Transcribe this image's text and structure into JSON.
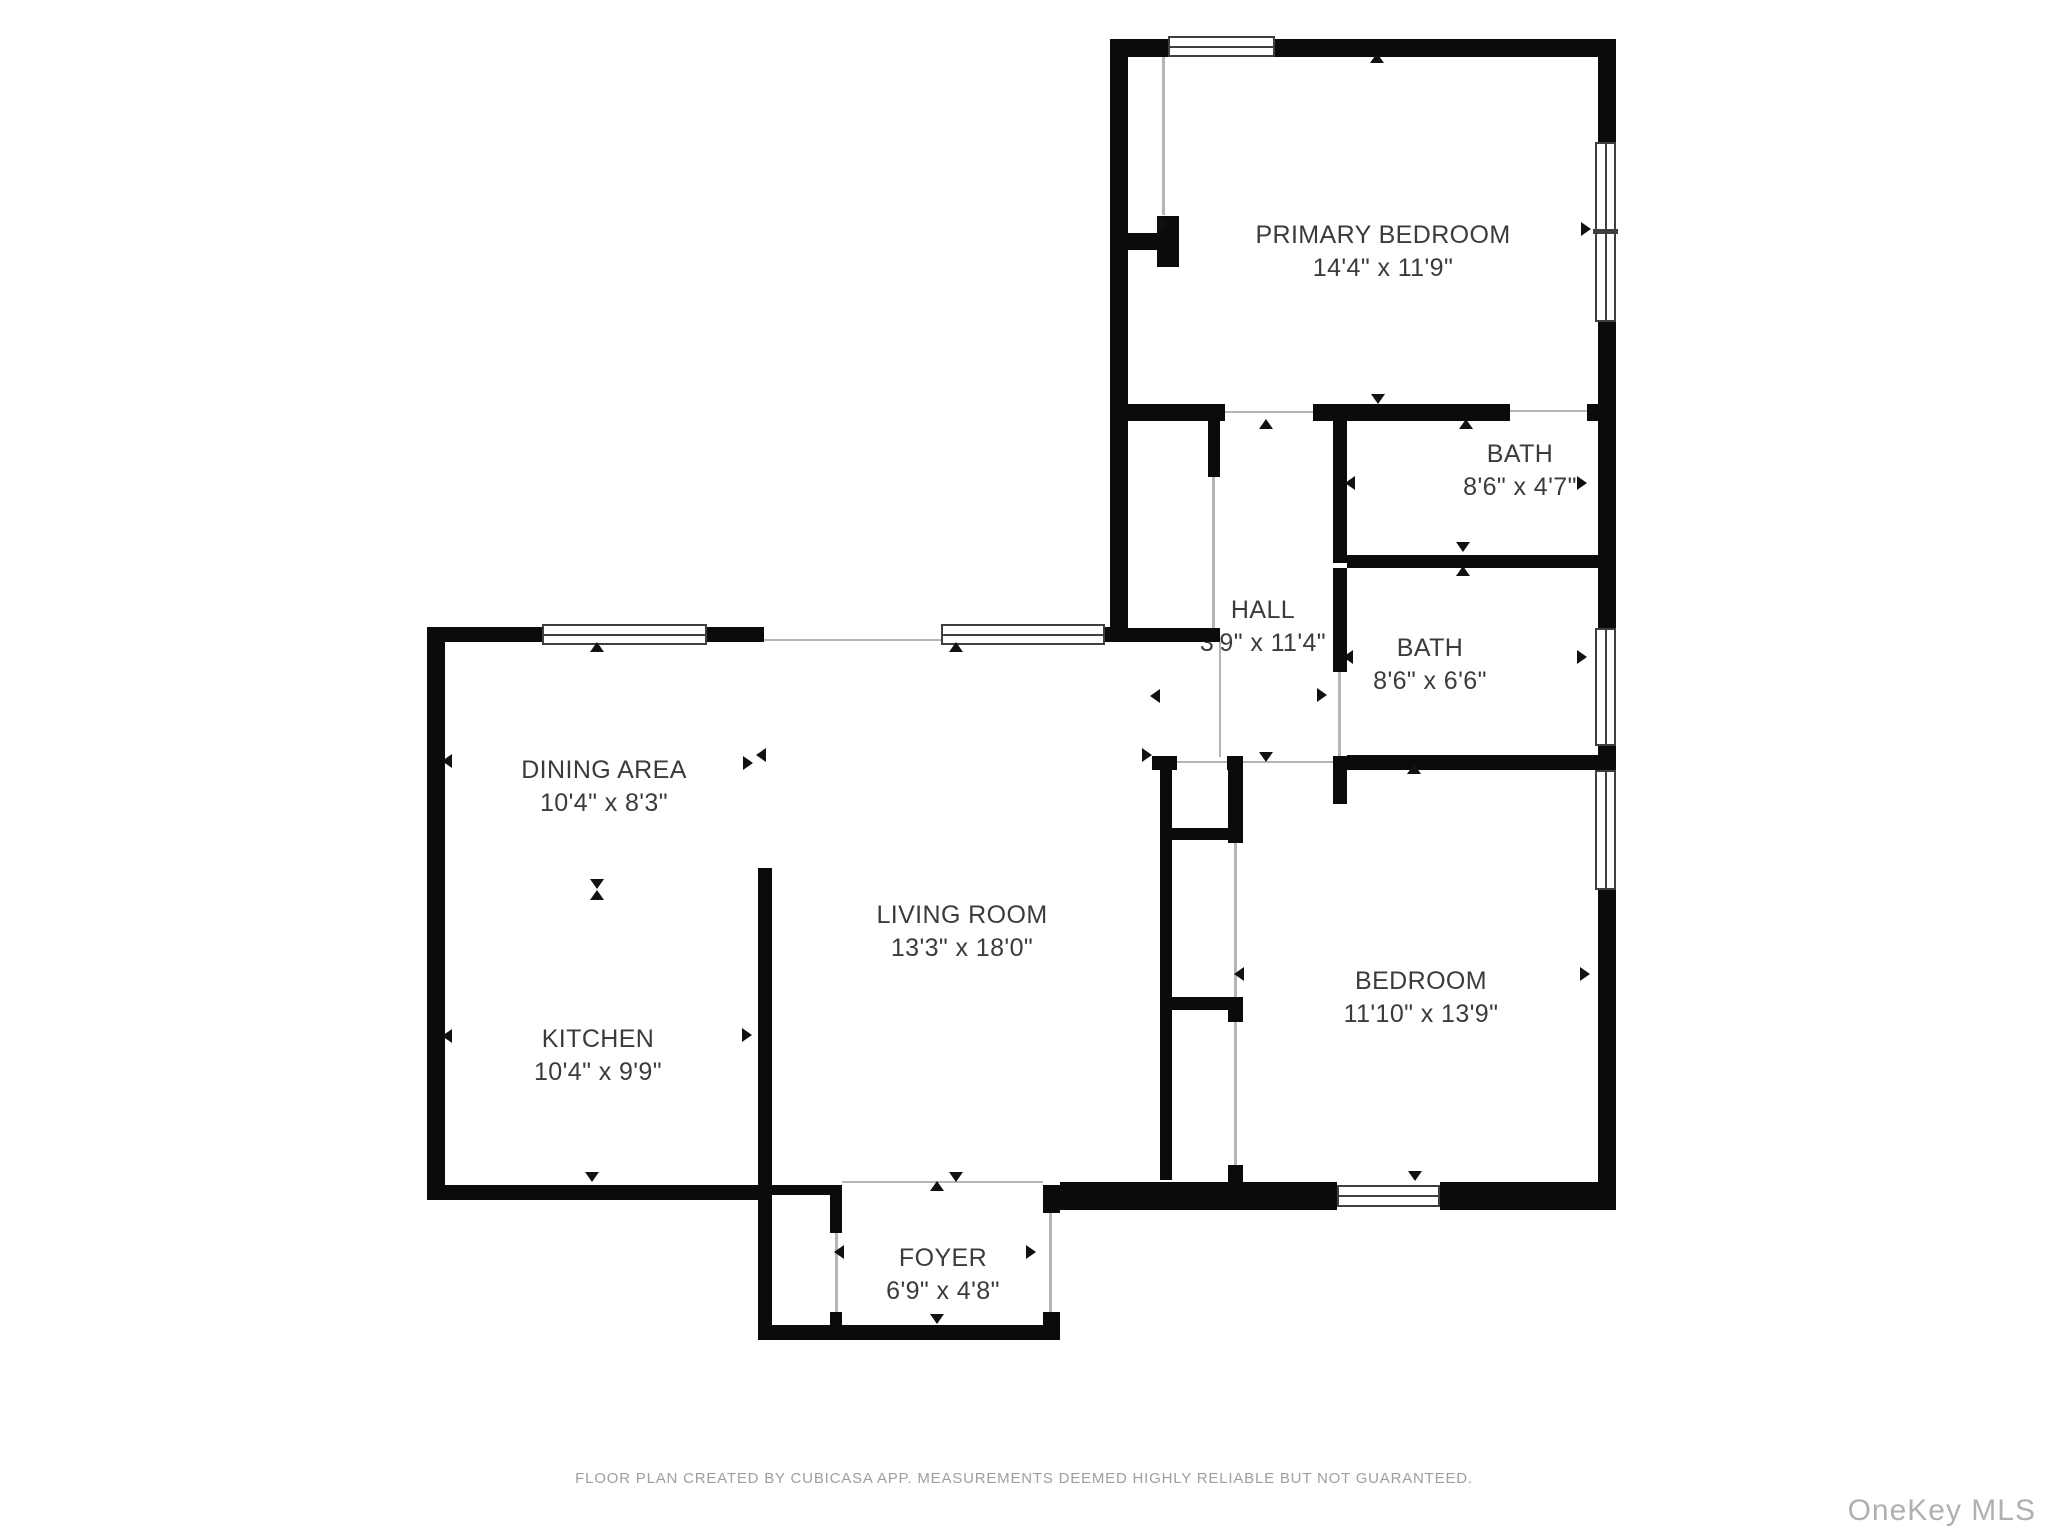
{
  "plan": {
    "creator_note": "FLOOR PLAN CREATED BY CUBICASA APP. MEASUREMENTS DEEMED HIGHLY RELIABLE BUT NOT GUARANTEED.",
    "watermark": "OneKey MLS"
  },
  "rooms": [
    {
      "id": "primary-bedroom",
      "name": "PRIMARY BEDROOM",
      "dims": "14'4\" x 11'9\""
    },
    {
      "id": "bath-1",
      "name": "BATH",
      "dims": "8'6\" x 4'7\""
    },
    {
      "id": "hall",
      "name": "HALL",
      "dims": "3'9\" x 11'4\""
    },
    {
      "id": "bath-2",
      "name": "BATH",
      "dims": "8'6\" x 6'6\""
    },
    {
      "id": "dining-area",
      "name": "DINING AREA",
      "dims": "10'4\" x 8'3\""
    },
    {
      "id": "living-room",
      "name": "LIVING ROOM",
      "dims": "13'3\" x 18'0\""
    },
    {
      "id": "kitchen",
      "name": "KITCHEN",
      "dims": "10'4\" x 9'9\""
    },
    {
      "id": "bedroom",
      "name": "BEDROOM",
      "dims": "11'10\" x 13'9\""
    },
    {
      "id": "foyer",
      "name": "FOYER",
      "dims": "6'9\" x 4'8\""
    }
  ],
  "colors": {
    "wall": "#0b0b0b",
    "label_text": "#3b3b3b",
    "footer_text": "#9e9e9e",
    "watermark_text": "#b1b0af"
  }
}
